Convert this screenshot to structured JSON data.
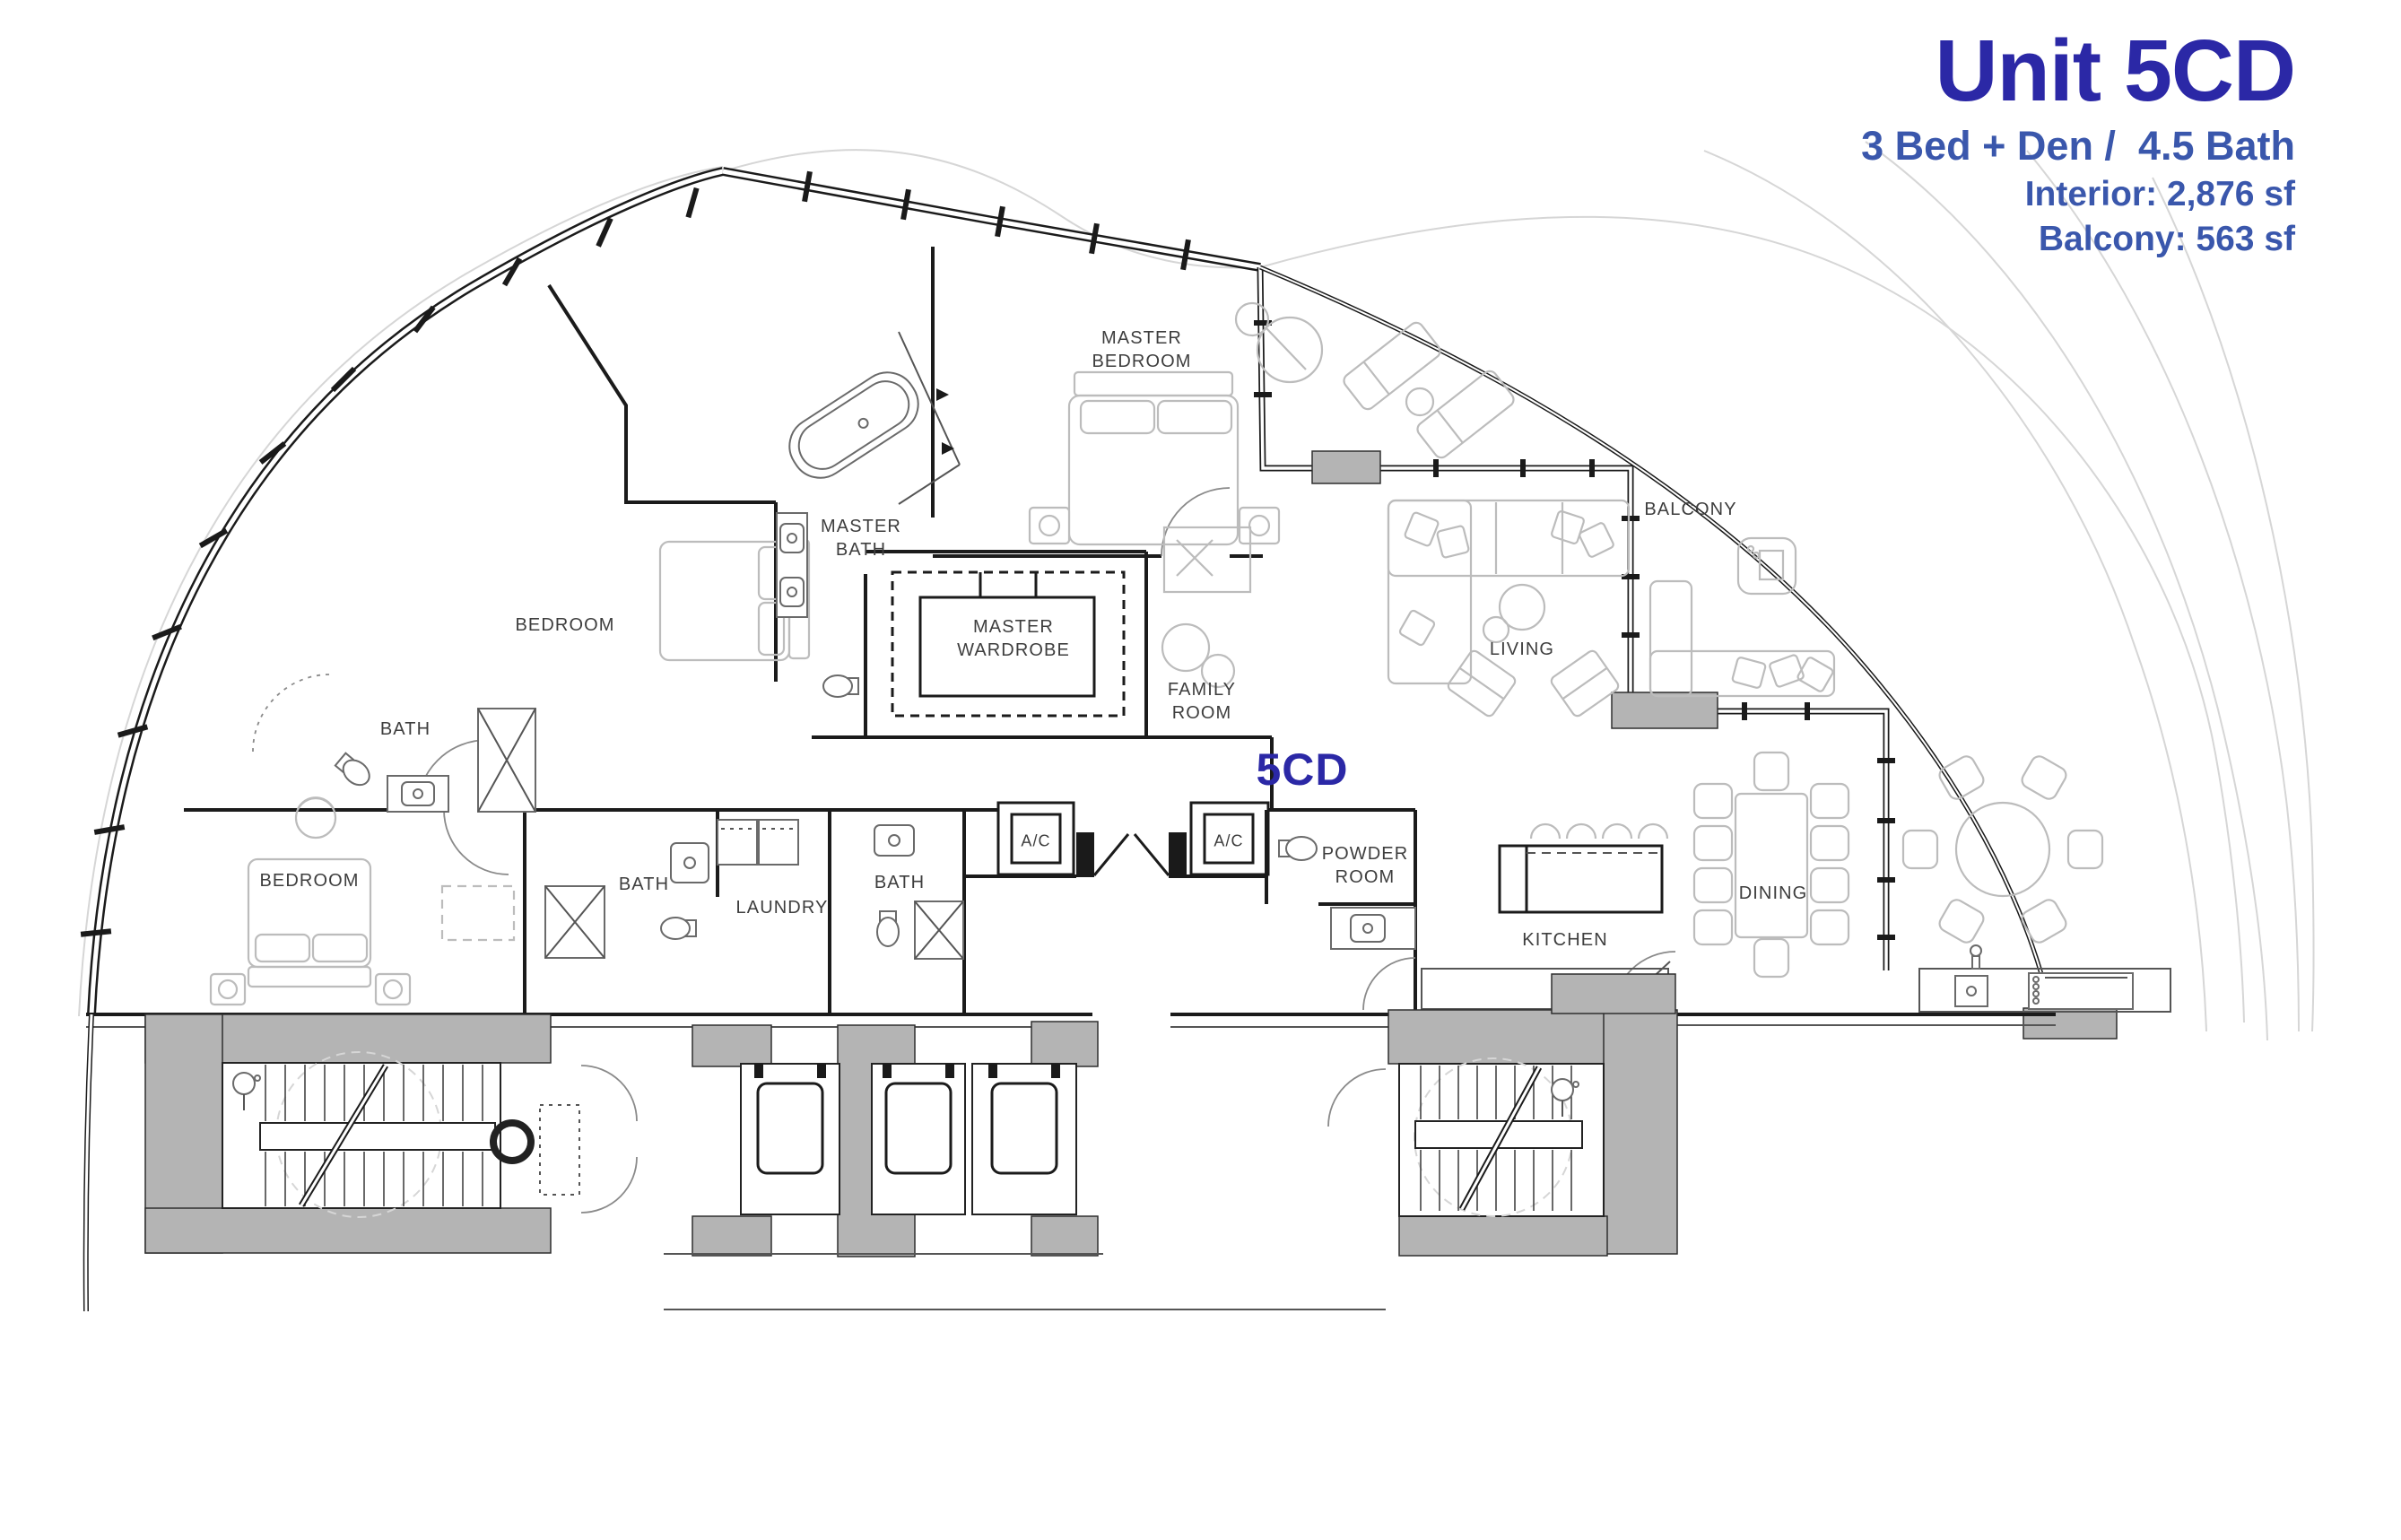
{
  "title_block": {
    "title": "Unit 5CD",
    "subtitle": "3 Bed + Den /  4.5 Bath",
    "interior": "Interior: 2,876 sf",
    "balcony": "Balcony: 563 sf"
  },
  "plan": {
    "unit_label": "5CD",
    "rooms": [
      {
        "id": "master-bedroom",
        "label": "MASTER\nBEDROOM"
      },
      {
        "id": "master-bath",
        "label": "MASTER\nBATH"
      },
      {
        "id": "bedroom-upper",
        "label": "BEDROOM"
      },
      {
        "id": "bath-upper",
        "label": "BATH"
      },
      {
        "id": "master-wardrobe",
        "label": "MASTER\nWARDROBE"
      },
      {
        "id": "family-room",
        "label": "FAMILY\nROOM"
      },
      {
        "id": "balcony",
        "label": "BALCONY"
      },
      {
        "id": "living",
        "label": "LIVING"
      },
      {
        "id": "dining",
        "label": "DINING"
      },
      {
        "id": "kitchen",
        "label": "KITCHEN"
      },
      {
        "id": "bedroom-lower",
        "label": "BEDROOM"
      },
      {
        "id": "bath-mid-left",
        "label": "BATH"
      },
      {
        "id": "laundry",
        "label": "LAUNDRY"
      },
      {
        "id": "bath-mid-right",
        "label": "BATH"
      },
      {
        "id": "ac-closet-1",
        "label": "A/C"
      },
      {
        "id": "ac-closet-2",
        "label": "A/C"
      },
      {
        "id": "powder-room",
        "label": "POWDER\nROOM"
      }
    ]
  },
  "colors": {
    "title_blue": "#2b28a6",
    "accent_blue": "#3a57ac",
    "label_gray": "#3e3e3e",
    "wall_black": "#1b1b1b",
    "poche_gray": "#b4b4b4",
    "furniture_gray": "#bcbcbc"
  }
}
